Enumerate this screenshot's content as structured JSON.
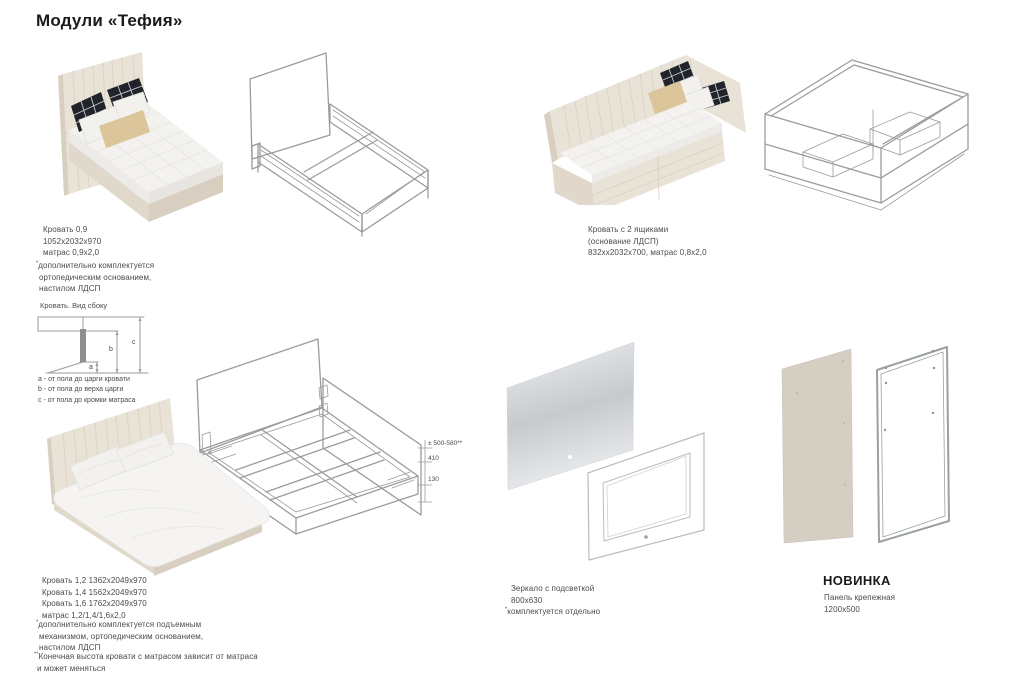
{
  "page": {
    "title": "Модули «Тефия»"
  },
  "colors": {
    "title_text": "#1a1a1a",
    "caption_text": "#4a4a4a",
    "wireframe": "#9b9b9b",
    "bed_beige": "#e9e2d7",
    "bed_beige_side": "#e0d8ca",
    "bed_beige_dark": "#d8cfc1",
    "mattress": "#f3f2ef",
    "pillow_black": "#20242a",
    "pillow_beige": "#dcc49b",
    "panel_beige": "#d5cec3",
    "mirror_light": "#eef0f2",
    "mirror_dark": "#c7cacd"
  },
  "sections": {
    "bed_single": {
      "caption": [
        "Кровать 0,9",
        "1052х2032х970",
        "матрас 0,9х2,0"
      ],
      "footnote": {
        "marker": "*",
        "lines": [
          "дополнительно комплектуется",
          "ортопедическим основанием,",
          "настилом ЛДСП"
        ]
      }
    },
    "bed_drawers": {
      "caption": [
        "Кровать с 2 ящиками",
        "(основание ЛДСП)",
        "832хх2032х700, матрас 0,8х2,0"
      ]
    },
    "side_view": {
      "title": "Кровать. Вид сбоку",
      "dim_letters": [
        "a",
        "b",
        "c"
      ],
      "legend": [
        "a - от пола до царги кровати",
        "b - от пола до верха царги",
        "c - от пола до кромки матраса"
      ]
    },
    "bed_double": {
      "caption": [
        "Кровать 1,2 1362х2049х970",
        "Кровать 1,4 1562х2049х970",
        "Кровать 1,6 1762х2049х970",
        "матрас 1,2/1,4/1,6х2,0"
      ],
      "footnote1": {
        "marker": "*",
        "lines": [
          "дополнительно комплектуется подъемным",
          "механизмом, ортопедическим основанием,",
          "настилом ЛДСП"
        ]
      },
      "footnote2": {
        "marker": "**",
        "lines": [
          "Конечная высота кровати с матрасом зависит от матраса",
          "и может меняться"
        ]
      },
      "dims": [
        "± 500-580**",
        "410",
        "130"
      ]
    },
    "mirror": {
      "caption": [
        "Зеркало с подсветкой",
        "800х630"
      ],
      "footnote": {
        "marker": "*",
        "lines": [
          "комплектуется отдельно"
        ]
      }
    },
    "panel": {
      "badge": "НОВИНКА",
      "caption": [
        "Панель крепежная",
        "1200х500"
      ]
    }
  }
}
